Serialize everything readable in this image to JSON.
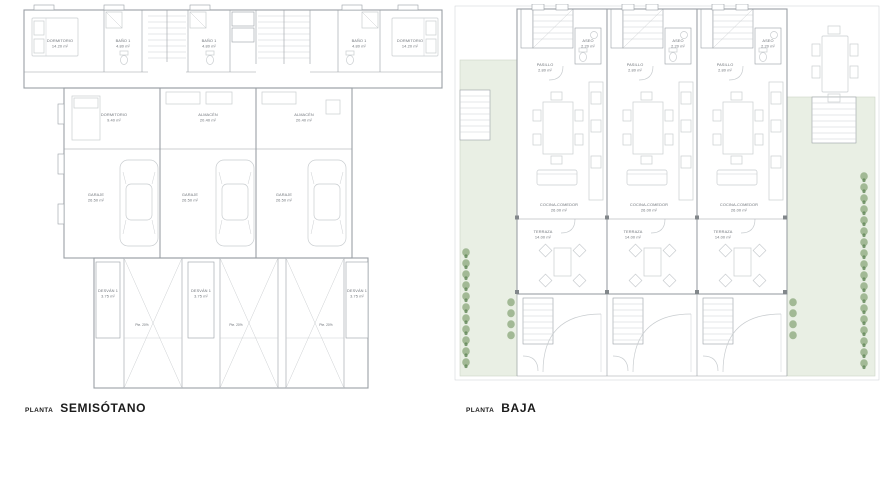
{
  "colors": {
    "wall": "#9aa0a5",
    "light": "#c9cdd0",
    "thin": "#c6cacd",
    "green": "#e9efe4",
    "plant": "#83a374",
    "text": "#6f747a",
    "caption": "#1b1b1b"
  },
  "captions": {
    "prefix": "PLANTA",
    "semisotano": "SEMISÓTANO",
    "baja": "BAJA"
  },
  "plans": {
    "semisotano": {
      "rooms": {
        "dormitorio_grande": {
          "name": "DORMITORIO",
          "area": "14.20 m²"
        },
        "bano1": {
          "name": "BAÑO 1",
          "area": "4.80 m²"
        },
        "dormitorio_peq": {
          "name": "DORMITORIO",
          "area": "9.40 m²"
        },
        "almacen": {
          "name": "ALMACÉN",
          "area": "20.40 m²"
        },
        "garaje": {
          "name": "GARAJE",
          "area": "26.50 m²"
        },
        "desvan": {
          "name": "DESVÁN 1",
          "area": "3.75 m²"
        },
        "pendiente": "Pte. 20%"
      }
    },
    "baja": {
      "rooms": {
        "aseo": {
          "name": "ASEO",
          "area": "2.20 m²"
        },
        "pasillo": {
          "name": "PASILLO",
          "area": "2.80 m²"
        },
        "cocina_comedor": {
          "name": "COCINA-COMEDOR",
          "area": "26.00 m²"
        },
        "terraza": {
          "name": "TERRAZA",
          "area": "14.00 m²"
        }
      }
    }
  }
}
